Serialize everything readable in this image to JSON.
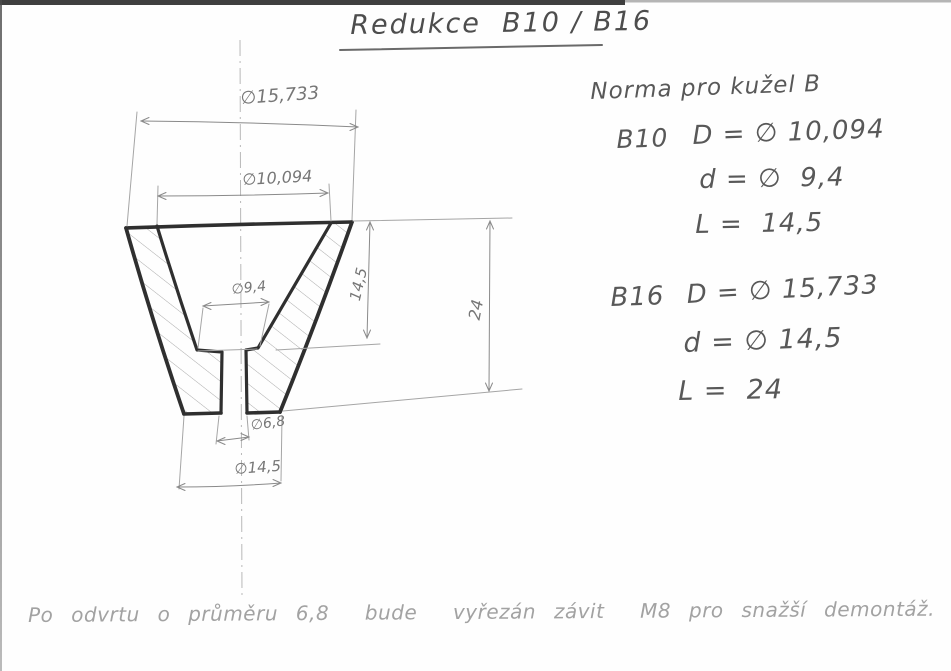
{
  "header": {
    "title": "Redukce  B10 / B16"
  },
  "drawing": {
    "dim_outer_top": "∅15,733",
    "dim_socket_top": "∅10,094",
    "dim_socket_bottom": "∅9,4",
    "dim_socket_depth": "14,5",
    "dim_overall_length": "24",
    "dim_through_hole": "∅6,8",
    "dim_outer_bottom": "∅14,5"
  },
  "norm_table": {
    "heading": "Norma pro kužel B",
    "entries": [
      {
        "name": "B10",
        "rows": [
          "D = ∅ 10,094",
          "d = ∅  9,4",
          "L =  14,5"
        ]
      },
      {
        "name": "B16",
        "rows": [
          "D = ∅ 15,733",
          "d = ∅ 14,5",
          "L =  24"
        ]
      }
    ]
  },
  "footnote": {
    "text": "Po odvrtu o průměru 6,8  bude  vyřezán závit  M8 pro snažší demontáž."
  },
  "colors": {
    "ink_dark": "#2f2f2f",
    "pencil_mid": "#8a8a8a",
    "pencil_light": "#b5b5b5",
    "scan_border": "#3f3f3f"
  }
}
